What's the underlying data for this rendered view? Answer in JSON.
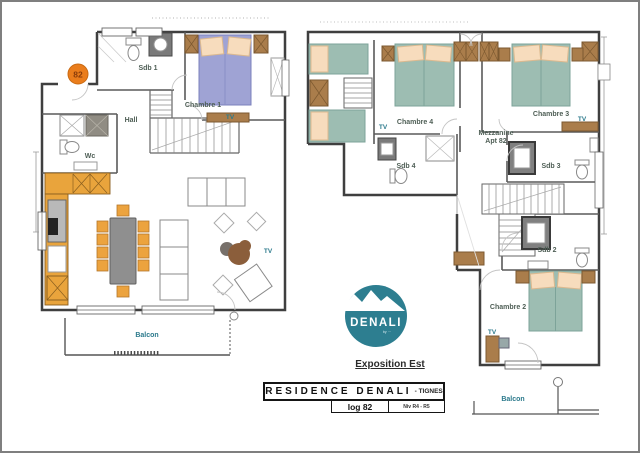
{
  "page": {
    "background": "#ffffff",
    "border_color": "#7f7f7f"
  },
  "badge": {
    "number": "82",
    "color": "#ea7d1c",
    "text_color": "#8a3c0a"
  },
  "floor1": {
    "labels": {
      "sdb1": "Sdb 1",
      "chambre1": "Chambre 1",
      "hall": "Hall",
      "wc": "Wc",
      "balcon": "Balcon",
      "tv_chambre1": "TV",
      "tv_living": "TV"
    }
  },
  "floor2": {
    "labels": {
      "chambre4": "Chambre 4",
      "chambre3": "Chambre 3",
      "sdb4": "Sdb 4",
      "sdb3": "Sdb 3",
      "sdb2": "Sdb 2",
      "chambre2": "Chambre 2",
      "balcon": "Balcon",
      "tv_chambre4": "TV",
      "tv_chambre3": "TV",
      "tv_chambre2": "TV",
      "mezzanine_line1": "Mezzanine",
      "mezzanine_line2": "Apt 82"
    }
  },
  "logo": {
    "name": "DENALI",
    "tagline": "by ···",
    "circle_color": "#2d7e90"
  },
  "footer": {
    "exposition": "Exposition Est",
    "residence": "RESIDENCE DENALI",
    "location_suffix": "- TIGNES",
    "unit": "log 82",
    "level": "Niv R4 - R5"
  },
  "colors": {
    "wall": "#3f3f3f",
    "bed_teal": "#9dbdb2",
    "bed_blue": "#9fa3d4",
    "pillow": "#f7dcbd",
    "wood": "#aa7d4b",
    "cabinet_orange": "#e9a43c",
    "table_gray": "#8f8f8f",
    "label_text": "#4e5e55",
    "accent_teal": "#2c7a8c"
  }
}
